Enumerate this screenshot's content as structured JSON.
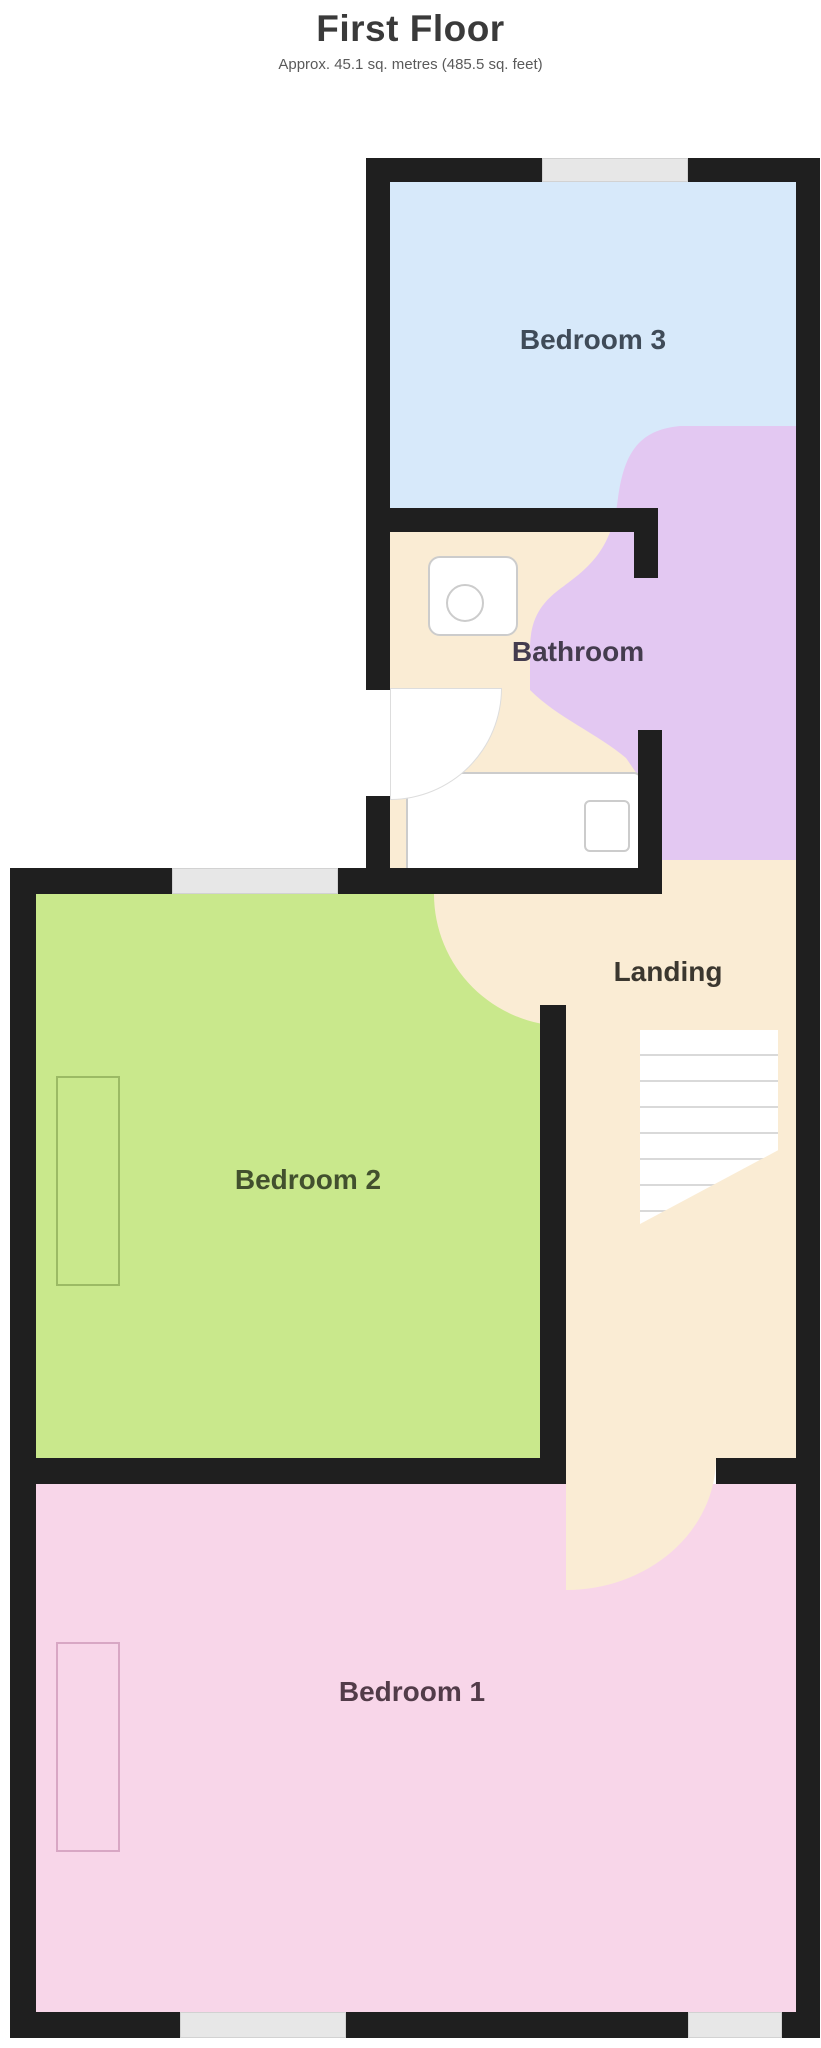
{
  "title": "First Floor",
  "subtitle": "Approx. 45.1 sq. metres (485.5 sq. feet)",
  "rooms": {
    "bedroom3": {
      "label": "Bedroom 3",
      "color": "#d7e9fa",
      "label_color": "#3f4b58"
    },
    "bathroom": {
      "label": "Bathroom",
      "color": "#e3c8f2",
      "label_color": "#443c4e"
    },
    "landing": {
      "label": "Landing",
      "color": "#faecd4",
      "label_color": "#3b372f"
    },
    "bedroom2": {
      "label": "Bedroom 2",
      "color": "#c9e88c",
      "label_color": "#42502e"
    },
    "bedroom1": {
      "label": "Bedroom 1",
      "color": "#f8d6e9",
      "label_color": "#523c49"
    }
  },
  "colors": {
    "wall": "#1f1f1f",
    "window": "#e7e7e7",
    "title_text": "#3a3a3a",
    "fixture_outline": "#cccccc",
    "stair_tread": "#d9d9d9"
  }
}
